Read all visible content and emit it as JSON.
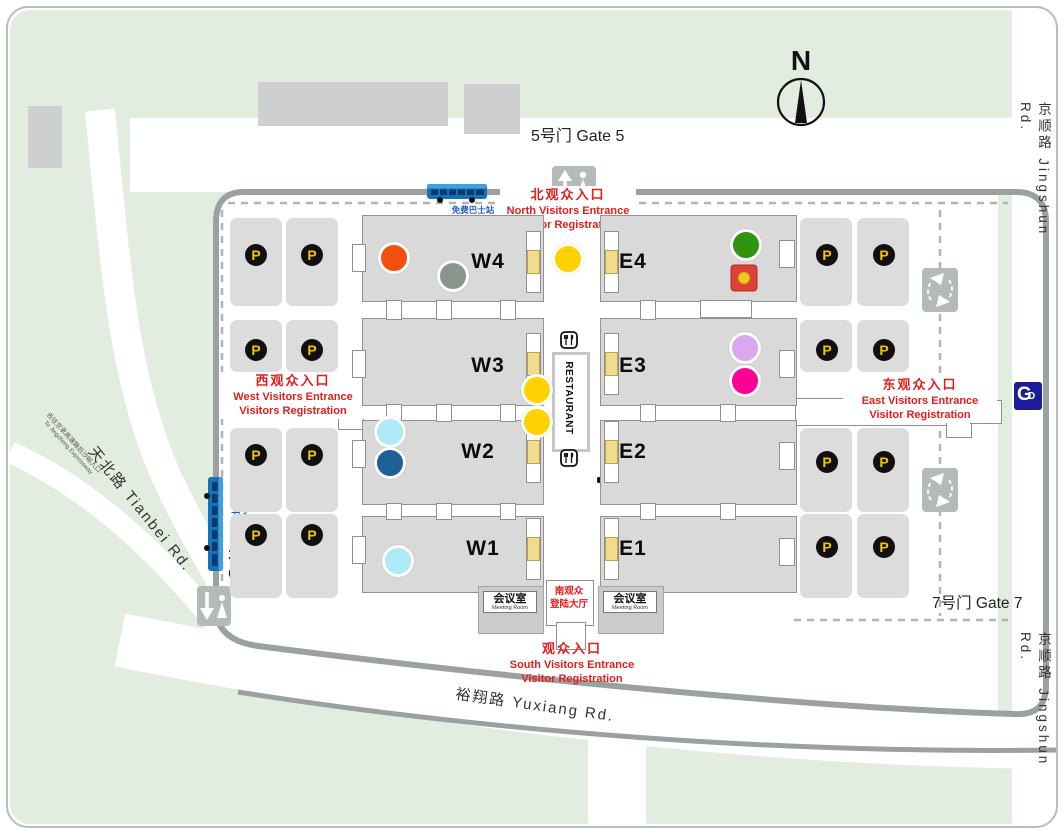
{
  "map": {
    "compass_label": "N",
    "roads": {
      "right": "京顺路 Jingshun Rd.",
      "left_diagonal": "天北路 Tianbei Rd.",
      "bottom": "裕翔路 Yuxiang Rd.",
      "expressway_cn": "去往京承高速路后沙峪入口",
      "expressway_en": "To Jingcheng Expressway"
    },
    "gates": {
      "gate5": "5号门 Gate 5",
      "gate3_cn": "3号门",
      "gate3_en": "Gate 3",
      "gate7": "7号门 Gate 7"
    },
    "entrances": {
      "north": {
        "cn": "北观众入口",
        "en1": "North Visitors Entrance",
        "en2": "Visitor Registration"
      },
      "west": {
        "cn": "西观众入口",
        "en1": "West Visitors Entrance",
        "en2": "Visitors Registration"
      },
      "east": {
        "cn": "东观众入口",
        "en1": "East Visitors Entrance",
        "en2": "Visitor Registration"
      },
      "south": {
        "cn": "观众入口",
        "en1": "South Visitors Entrance",
        "en2": "Visitor Registration"
      }
    },
    "shuttle": {
      "cn": "免费巴士站",
      "en": "Shuttle bus departure area"
    },
    "south_hall": {
      "line1": "南观众",
      "line2": "登陆大厅"
    },
    "meeting_room": {
      "cn": "会议室",
      "en": "Meeting Room"
    },
    "restaurant_label": "RESTAURANT",
    "parking_symbol": "P",
    "halls": [
      {
        "label": "W4",
        "rect": [
          362,
          215,
          180,
          85
        ],
        "label_pos": [
          488,
          262
        ]
      },
      {
        "label": "W3",
        "rect": [
          362,
          318,
          180,
          86
        ],
        "label_pos": [
          488,
          366
        ]
      },
      {
        "label": "W2",
        "rect": [
          362,
          420,
          180,
          83
        ],
        "label_pos": [
          478,
          452
        ]
      },
      {
        "label": "W1",
        "rect": [
          362,
          516,
          180,
          75
        ],
        "label_pos": [
          483,
          549
        ]
      },
      {
        "label": "E4",
        "rect": [
          600,
          215,
          195,
          85
        ],
        "label_pos": [
          633,
          262
        ]
      },
      {
        "label": "E3",
        "rect": [
          600,
          318,
          195,
          86
        ],
        "label_pos": [
          633,
          366
        ]
      },
      {
        "label": "E2",
        "rect": [
          600,
          420,
          195,
          83
        ],
        "label_pos": [
          633,
          452
        ]
      },
      {
        "label": "E1",
        "rect": [
          600,
          516,
          195,
          75
        ],
        "label_pos": [
          633,
          549
        ]
      }
    ],
    "parking_spots": [
      [
        256,
        255
      ],
      [
        312,
        255
      ],
      [
        256,
        350
      ],
      [
        312,
        350
      ],
      [
        256,
        455
      ],
      [
        312,
        455
      ],
      [
        256,
        535
      ],
      [
        312,
        535
      ],
      [
        827,
        255
      ],
      [
        884,
        255
      ],
      [
        827,
        350
      ],
      [
        884,
        350
      ],
      [
        827,
        462
      ],
      [
        884,
        462
      ],
      [
        827,
        547
      ],
      [
        884,
        547
      ]
    ],
    "markers": [
      {
        "name": "marker-orange-dot",
        "type": "dot",
        "color": "#f4500c",
        "x": 394,
        "y": 258
      },
      {
        "name": "marker-gray-dot",
        "type": "dot",
        "color": "#8c948e",
        "x": 453,
        "y": 276
      },
      {
        "name": "marker-yellow-dot-north",
        "type": "dot",
        "color": "#ffd200",
        "x": 568,
        "y": 259
      },
      {
        "name": "marker-green-dot",
        "type": "dot",
        "color": "#2f9412",
        "x": 746,
        "y": 245
      },
      {
        "name": "marker-red-envelope",
        "type": "redbox",
        "color": "#de3f36",
        "x": 744,
        "y": 278
      },
      {
        "name": "marker-lavender-dot",
        "type": "dot",
        "color": "#d9a8ef",
        "x": 745,
        "y": 348
      },
      {
        "name": "marker-magenta-dot",
        "type": "dot",
        "color": "#ff0095",
        "x": 745,
        "y": 381
      },
      {
        "name": "marker-yellow-dot-mid1",
        "type": "dot",
        "color": "#ffd200",
        "x": 537,
        "y": 390
      },
      {
        "name": "marker-yellow-dot-mid2",
        "type": "dot",
        "color": "#ffd200",
        "x": 537,
        "y": 422
      },
      {
        "name": "marker-cyan-dot-w2",
        "type": "dot",
        "color": "#aee9f7",
        "x": 390,
        "y": 432
      },
      {
        "name": "marker-blue-dot-w2",
        "type": "dot",
        "color": "#1d5f98",
        "x": 390,
        "y": 463
      },
      {
        "name": "marker-cyan-dot-w1",
        "type": "dot",
        "color": "#aee9f7",
        "x": 398,
        "y": 561
      }
    ],
    "colors": {
      "green_area": "#e2ecdf",
      "road_white": "#ffffff",
      "boundary_gray": "#9aa1a1",
      "hall_gray": "#d9d9d9",
      "accent_red": "#e31d1a",
      "shuttle_blue": "#1b5ac8",
      "parking_yellow": "#f5c400",
      "subway_blue": "#1c1c99"
    }
  }
}
